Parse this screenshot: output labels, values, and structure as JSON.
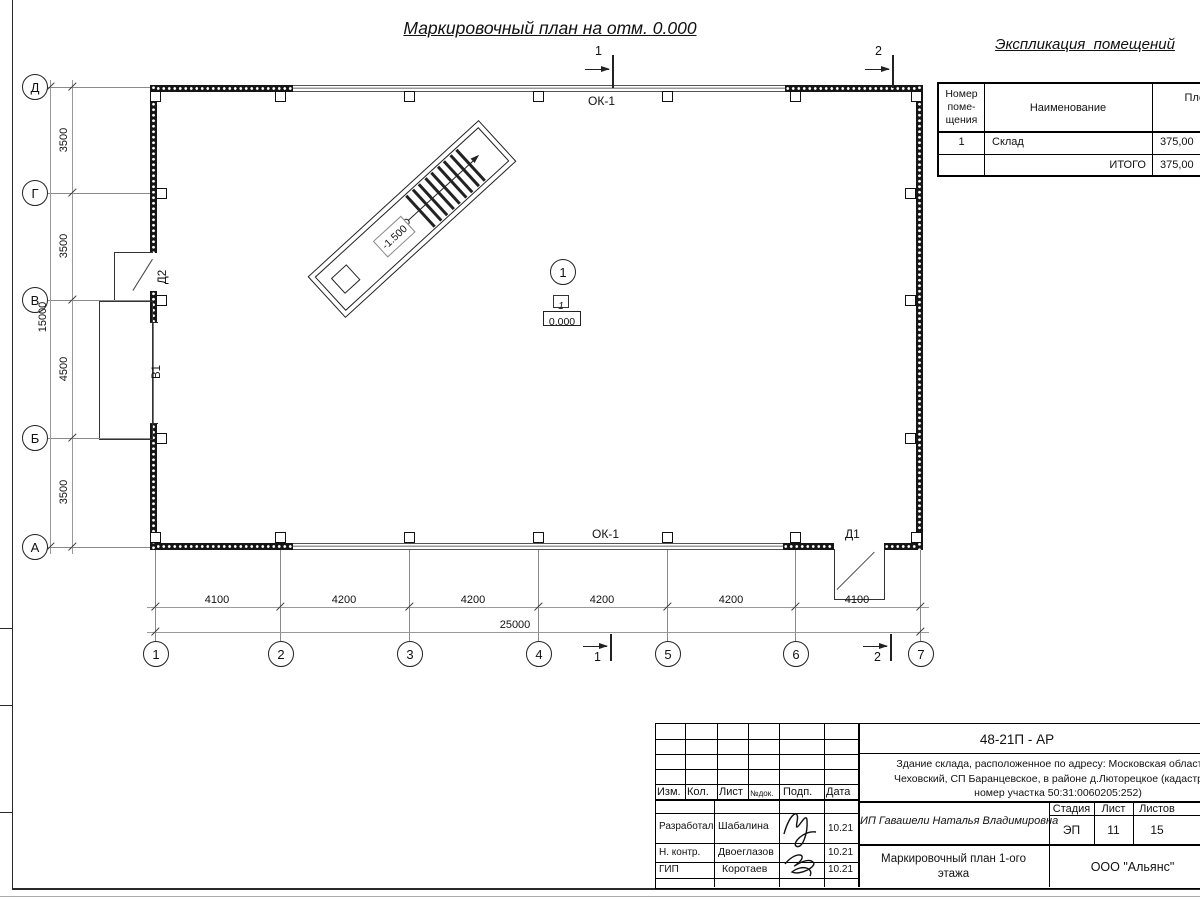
{
  "page_title": "Маркировочный план на отм. 0.000",
  "schedule": {
    "title": "Экспликация  помещений",
    "col_num_l1": "Номер",
    "col_num_l2": "поме-",
    "col_num_l3": "щения",
    "col_name": "Наименование",
    "col_area_l1": "Площадь",
    "col_area_unit": "м",
    "col_area_sup": "2",
    "rows": [
      {
        "num": "1",
        "name": "Склад",
        "area": "375,00"
      },
      {
        "num": "",
        "name": "ИТОГО",
        "area": "375,00"
      }
    ]
  },
  "plan": {
    "axes_left": [
      "Д",
      "Г",
      "В",
      "Б",
      "А"
    ],
    "axes_bottom": [
      "1",
      "2",
      "3",
      "4",
      "5",
      "6",
      "7"
    ],
    "dims_left": [
      "3500",
      "3500",
      "4500",
      "3500"
    ],
    "dims_left_total": "15000",
    "dims_bottom": [
      "4100",
      "4200",
      "4200",
      "4200",
      "4200",
      "4100"
    ],
    "dims_bottom_total": "25000",
    "window_label_top": "ОК-1",
    "window_label_bottom": "ОК-1",
    "door1": "Д1",
    "door2": "Д2",
    "gate1": "В1",
    "stairs_elevation": "-1.500",
    "room_marker": "1",
    "room_number": "1",
    "room_elevation": "0.000",
    "section1": "1",
    "section2": "2"
  },
  "titleblock": {
    "doc_number": "48-21П - АР",
    "desc_l1": "Здание склада, расположенное по адресу: Московская область, р",
    "desc_l2": "Чеховский, СП Баранцевское, в районе д.Люторецкое  (кадастровы",
    "desc_l3": "номер участка 50:31:0060205:252)",
    "h_izm": "Изм.",
    "h_kol": "Кол.",
    "h_list": "Лист",
    "h_ndok": "№док.",
    "h_podp": "Подп.",
    "h_data": "Дата",
    "roles": [
      {
        "role": "Разработал",
        "name": "Шабалина",
        "date": "10.21"
      },
      {
        "role": "Н. контр.",
        "name": "Двоеглазов",
        "date": "10.21"
      },
      {
        "role": "ГИП",
        "name": "Коротаев",
        "date": "10.21"
      }
    ],
    "client": "ИП Гавашели Наталья Владимировна",
    "h_stage": "Стадия",
    "h_sheet": "Лист",
    "h_sheets": "Листов",
    "stage": "ЭП",
    "sheet": "11",
    "sheets": "15",
    "sheet_title_l1": "Маркировочный план 1-ого",
    "sheet_title_l2": "этажа",
    "company": "ООО \"Альянс\""
  }
}
